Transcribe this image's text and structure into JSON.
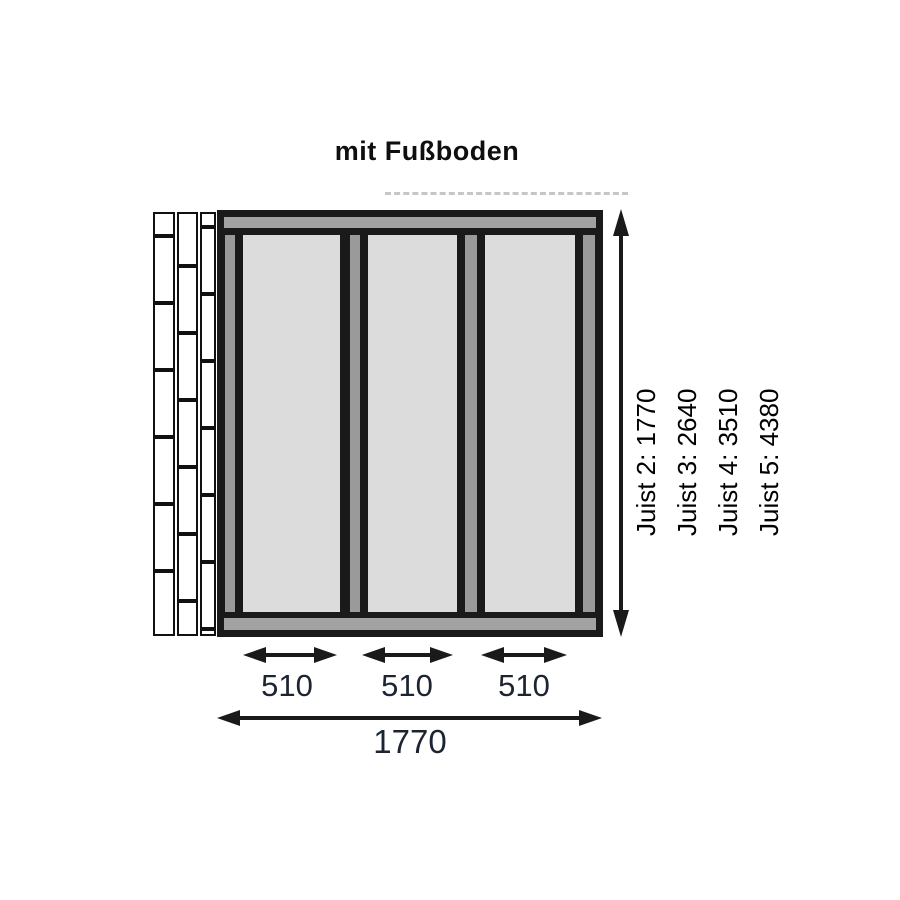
{
  "title": "mit Fußboden",
  "dimensions": {
    "segment_labels": [
      "510",
      "510",
      "510"
    ],
    "total_label": "1770",
    "joist_lines": [
      "Juist 2: 1770",
      "Juist 3: 2640",
      "Juist 4: 3510",
      "Juist 5: 4380"
    ]
  },
  "colors": {
    "outline_black": "#1a1a1a",
    "beam_gray": "#a2a2a2",
    "stud_gray": "#9a9a9a",
    "panel_gray": "#dcdcdc",
    "board_white": "#ffffff",
    "dimension_text": "#1b2430"
  }
}
